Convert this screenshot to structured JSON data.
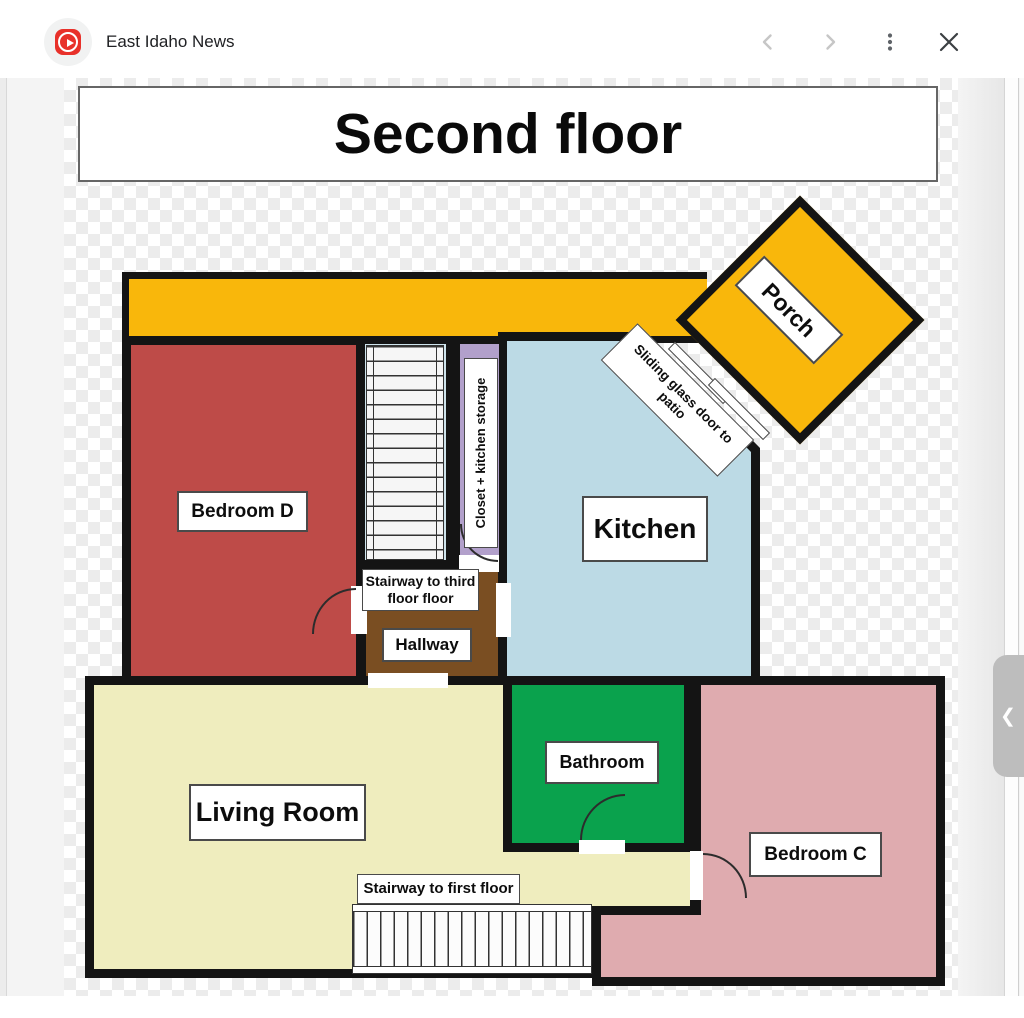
{
  "header": {
    "source_name": "East Idaho News"
  },
  "viewer": {
    "story_prev_handle_glyph": "❮"
  },
  "floorplan": {
    "title": "Second floor",
    "rooms": {
      "porch": "Porch",
      "bedroom_d": "Bedroom D",
      "closet": "Closet + kitchen storage",
      "kitchen": "Kitchen",
      "sliding_door": "Sliding glass door to patio",
      "stairway_third": "Stairway to third floor floor",
      "hallway": "Hallway",
      "living_room": "Living Room",
      "bathroom": "Bathroom",
      "bedroom_c": "Bedroom C",
      "stairway_first": "Stairway to first floor"
    },
    "colors": {
      "wall": "#141414",
      "porch_balcony": "#F9B70B",
      "bedroom_d": "#BE4B48",
      "kitchen": "#BCDAE5",
      "stairwell": "#CFE4EC",
      "closet": "#B2A0CB",
      "hallway": "#7A4E22",
      "living_room": "#EFEDBE",
      "bathroom": "#0AA24D",
      "bedroom_c": "#DFABAF",
      "logo_red": "#E8312A"
    }
  }
}
